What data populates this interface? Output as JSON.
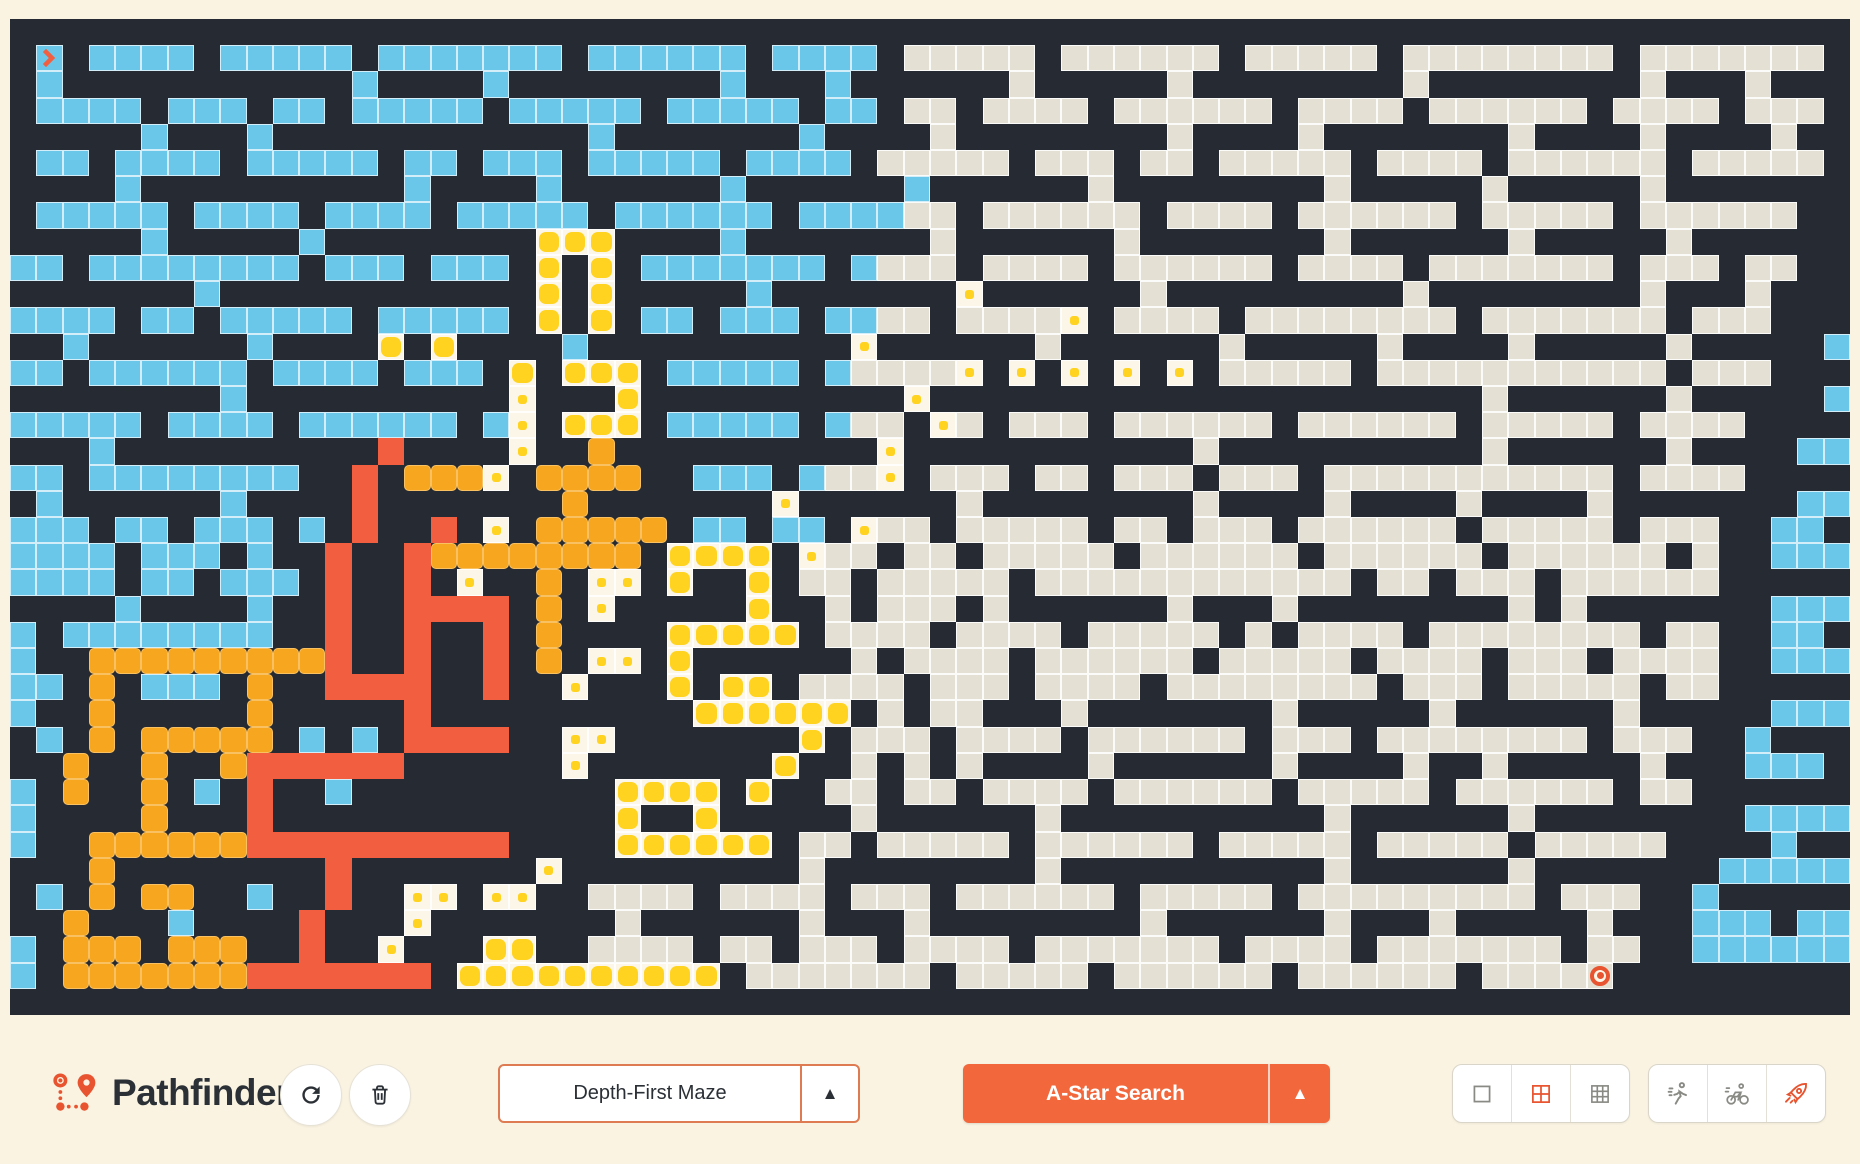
{
  "app": {
    "title": "Pathfinder"
  },
  "controls": {
    "refresh_button": {
      "icon": "refresh-icon"
    },
    "clear_button": {
      "icon": "trash-icon"
    },
    "maze_select": {
      "value": "Depth-First Maze",
      "arrow": "▲"
    },
    "search_button": {
      "label": "A-Star Search",
      "arrow": "▲"
    },
    "view_options": {
      "items": [
        "grid-single",
        "grid-2x2",
        "grid-3x3"
      ],
      "selected": "grid-2x2"
    },
    "speed_options": {
      "items": [
        "runner",
        "cyclist",
        "rocket"
      ],
      "selected": "rocket"
    }
  },
  "colors": {
    "page_background": "#FAF3E2",
    "wall": "#262B33",
    "visited": "#6BC7E9",
    "unvisited": "#E4E0D3",
    "frontier_yellow": "#FFD31F",
    "candidate_orange": "#F7A71F",
    "path_red": "#F15F40",
    "accent_orange": "#F2683C"
  },
  "maze": {
    "cols": 70,
    "rows": 38,
    "start": {
      "row": 1,
      "col": 1
    },
    "goal": {
      "row": 36,
      "col": 68
    },
    "legend": {
      "#": "wall",
      "b": "visited",
      "u": "unvisited",
      "f": "frontier-big",
      "d": "frontier-dot",
      "o": "candidate",
      "r": "path",
      "s": "start",
      "g": "goal"
    },
    "grid": [
      "######################################################################",
      "#s#bbbb#bbbbb#bbbbbbb#bbbbbb#bbbb#uuuuu#uuuuuu#uuuuu#uuuuuuuu#uuuuuuu#",
      "#b###########b####b########b###b######u#####u########u########u###u###",
      "#bbbb#bbb#bb#bbbbb#bbbbb#bbbbb#bb#uu#uuuu#uuuuuu#uuuu#uuuuuu#uuuu#uuu#",
      "#####b###b############b#######b####u########u####u#######u####u####u##",
      "#bb#bbbb#bbbbb#bb#bbb#bbbbb#bbbb#uuuuu#uuu#uu#uuuuu#uuuu#uuuuuu#uuuuu#",
      "####b##########b####b######b######b######u########u#####u#####u#######",
      "#bbbbb#bbbb#bbbb#bbbbb#bbbbbb#bbbbuu#uuuuuu#uuuu#uuuuuu#uuuuu#uuuuuu#",
      "######b#####b########fff####b#######u######u#######u######u#####u#####",
      "#bb#bbbbbbbb#bbb#bbb#f#f#bbbbbbb#buuu#uuuu#uuuuuu#uuuu#uuuuuuu#uuu#uu#",
      "########b############f#f#####b#######d######u#########u########u###u##",
      "#bbbb#bb#bbbbb#bbbbb#f#f#bb#bbb#bbuu#uuuud#uuuu#uuuuuuuu#uuuuuuu#uuu#",
      "####b######b####f#f####b##########d######u######u#####u####u#####u####",
      "#bbb#bbbbbb#bbbb#bbb#f#fff#bbbbb#buuuud#d#d#d#d#uuuuu#uuuuuuuuuuu#uuu#",
      "##########b##########d###f##########d#####################u######u####",
      "#bbbbbb#bbbb#bbbbbb#bd#fff#bbbbb#buu#du#uuu#uuuuuu#uuuuuu#uuuuu#uuuu#",
      "######b##########r####d##o##########d###########u##########u######u###",
      "#bbbb#bbbbbbbb##r#oood#oooo##bbb#buud#uuu#uu#uuu#uuu#uuuuuuuuuuu#uuuu#",
      "####b######b####r#######o#######d######u########u####u####u####u######",
      "#bbbbb#bb#bbb#b#r##r#d#ooooo#bb#bb#duu#uuuuu#uu#uuu#uuuuuu#uuuuu#uuu#",
      "#bb#bbbb#bbb#b##r##roooooooo#ffff#duu#uu#uuuuu#uuuuuu#uuuuuu#uuuuuu#u#",
      "#bbbbbbb#bb#bbb#r##r#d##o#dd#f##f#uu#uuuuu#uuuuuuuuuuuu#uu#uuu#uuuuuu#",
      "########b####b##r##rrrr#o#d#####f##u#uuu#u######u###u########u#u######",
      "#bbbb#bbbbbbbb##r##r##r#o####fffff#uuuu#uuuu#uuuuu#u#uuuu#uuuuuuuu#uu#",
      "#bb#b##ooooooooor##r##r#o#dd#f######u#uuuu#uuuuuu#uuuuu#uuuu#uuu#uuuu#",
      "#bbbbb#o#bbb#o##rrrr##r##d###f#ff#uuuu#uuu#uuuu#uuuuuuuu#uuu#uuuuu#uu#",
      "####b##o#####o#####r##########ffffff#u#uu###u#######u#####u######u####",
      "#bbb#b#o#ooooo#b#b#rrrr##dd#######f#uuu#uuuu#uuuuuu#uuu#uuuuuuuu#uuu#",
      "#b#####o##o##orrrrrr######d#######f##u#u#u####u######u####u##u#####u##",
      "#bbb#b#o##o#b#r##b##########ffff#f##uu#uu#uuuu#uuuuuu#uuuuu#uuuuuu#uu#",
      "#####b####o###r#############f##f#####u######u##########u######u#######",
      "#bbbbb##oooooorrrrrrrrrr####ffffff#uu#uuuuu#uuuuuu#uuuuu#uuuuu#uuuuu#",
      "###b#####o########r#######d#########u########u##########u######u######",
      "#bbbbb#b#o#oo##b##r##dd#dd##uuuu#uuuu#uuu#uuuuuu#uuuuu#uuuuuuuuu#uuu#",
      "#b#######o###b####r###d#######u######u###u########u######u###u#####u##",
      "#bbb#bbb#ooo#ooo##r##d###ff##uuuu#uu#uuu#uuuu#uuuuuuu#uuuu#uuuuuuu#uu#",
      "#bbbbbbb#ooooooorrrrrrr#ffffffffff#uuuuuuu#uuuuu#uuuuuu#uuuuuu#uuuug#",
      "######################################################################"
    ]
  }
}
